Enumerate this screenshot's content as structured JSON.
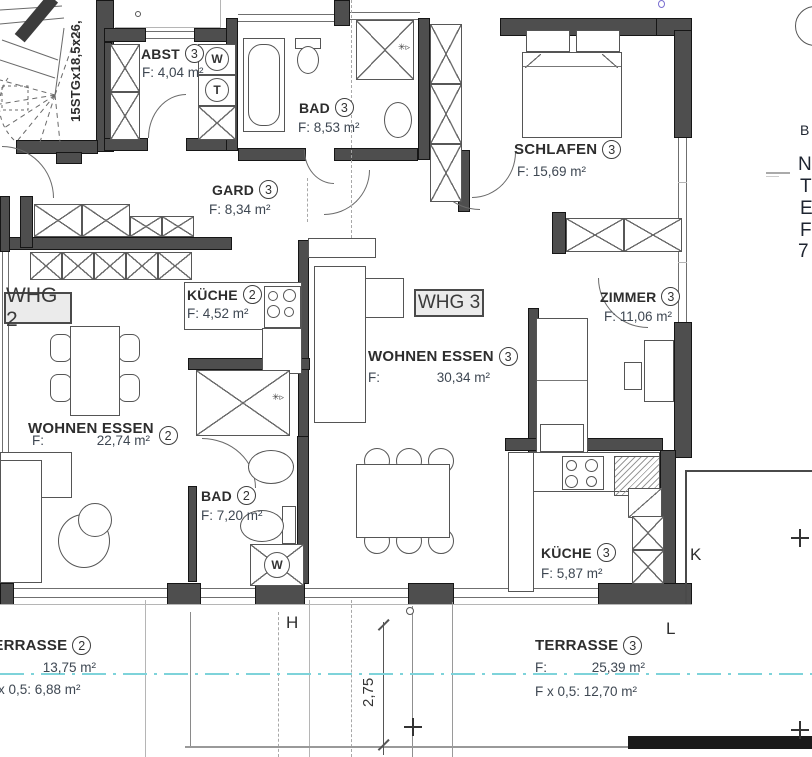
{
  "plan": {
    "units": {
      "whg2": "WHG 2",
      "whg3": "WHG 3"
    },
    "rooms": {
      "abst": {
        "name": "ABST",
        "num": "3",
        "area": "F: 4,04 m²"
      },
      "bad3": {
        "name": "BAD",
        "num": "3",
        "area": "F: 8,53 m²"
      },
      "schlafen": {
        "name": "SCHLAFEN",
        "num": "3",
        "area": "F: 15,69 m²"
      },
      "gard": {
        "name": "GARD",
        "num": "3",
        "area": "F: 8,34 m²"
      },
      "kueche2": {
        "name": "KÜCHE",
        "num": "2",
        "area": "F: 4,52 m²"
      },
      "zimmer": {
        "name": "ZIMMER",
        "num": "3",
        "area": "F: 11,06 m²"
      },
      "wohnen3": {
        "name": "WOHNEN ESSEN",
        "num": "3",
        "area_label": "F:",
        "area_value": "30,34 m²"
      },
      "wohnen2": {
        "name": "WOHNEN ESSEN",
        "num": "2",
        "area_label": "F:",
        "area_value": "22,74 m²"
      },
      "bad2": {
        "name": "BAD",
        "num": "2",
        "area": "F: 7,20 m²"
      },
      "kueche3": {
        "name": "KÜCHE",
        "num": "3",
        "area": "F: 5,87 m²"
      }
    },
    "terraces": {
      "t2": {
        "name": "TERRASSE",
        "num": "2",
        "area_label": "F:",
        "area_value": "13,75 m²",
        "half": "F x 0,5: 6,88 m²"
      },
      "t3": {
        "name": "TERRASSE",
        "num": "3",
        "area_label": "F:",
        "area_value": "25,39 m²",
        "half": "F x 0,5: 12,70 m²"
      }
    },
    "stair_label": "15STGx18,5x26,",
    "dimension": "2,75",
    "grid": {
      "h": "H",
      "k": "K",
      "l": "L"
    },
    "edge": {
      "l1": "B",
      "l2": "N",
      "l3": "T",
      "l4": "E",
      "l5": "F",
      "l6": "7"
    },
    "icons": {
      "washer": "W",
      "dryer": "T",
      "washer2": "W",
      "shower": "✳▹",
      "shower2": "✳▹"
    },
    "colors": {
      "wall": "#4e4e4e",
      "axis": "#7ed3da",
      "name_text": "#2d2d2d",
      "area_text": "#3e4752"
    }
  }
}
